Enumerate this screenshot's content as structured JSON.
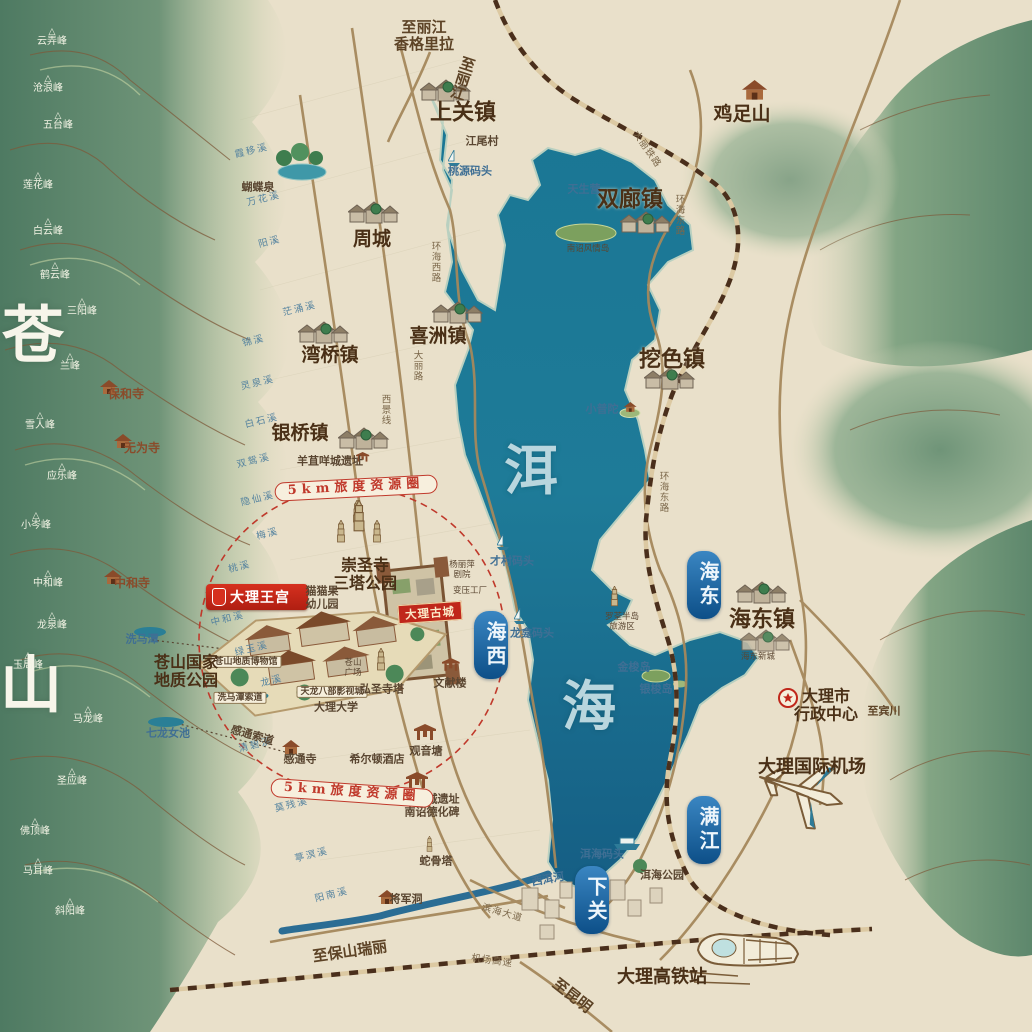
{
  "title": "大理洱海手绘旅游地图",
  "colors": {
    "paper": "#e9e0ca",
    "lake": "#1e7b98",
    "mountain_green": "#5f8a6e",
    "road": "#a5885c",
    "railway_dark": "#4a2f1c",
    "accent_red": "#c0392b",
    "stream_blue": "#55839f",
    "capsule_blue": "#0d4f88",
    "town_brown": "#4a3017"
  },
  "resort": {
    "logo": "大理王宫"
  },
  "old_town": {
    "label": "大理古城"
  },
  "labels": {
    "big_chars": [
      {
        "t": "苍",
        "x": 34,
        "y": 335,
        "cls": "mt"
      },
      {
        "t": "山",
        "x": 32,
        "y": 685,
        "cls": "mt"
      },
      {
        "t": "洱",
        "x": 532,
        "y": 470,
        "cls": "lake"
      },
      {
        "t": "海",
        "x": 590,
        "y": 706,
        "cls": "lake"
      }
    ],
    "regions": [
      {
        "t": "海西",
        "x": 491,
        "y": 645
      },
      {
        "t": "海东",
        "x": 704,
        "y": 585
      },
      {
        "t": "满江",
        "x": 704,
        "y": 830
      },
      {
        "t": "下关",
        "x": 592,
        "y": 900
      }
    ],
    "towns": [
      {
        "t": "上关镇",
        "x": 463,
        "y": 113,
        "cls": "lg"
      },
      {
        "t": "周城",
        "x": 372,
        "y": 240
      },
      {
        "t": "喜洲镇",
        "x": 438,
        "y": 337
      },
      {
        "t": "湾桥镇",
        "x": 330,
        "y": 356
      },
      {
        "t": "银桥镇",
        "x": 300,
        "y": 434
      },
      {
        "t": "双廊镇",
        "x": 630,
        "y": 200,
        "cls": "lg"
      },
      {
        "t": "挖色镇",
        "x": 672,
        "y": 360,
        "cls": "lg"
      },
      {
        "t": "海东镇",
        "x": 762,
        "y": 620,
        "cls": "lg"
      },
      {
        "t": "鸡足山",
        "x": 742,
        "y": 115
      }
    ],
    "peaks": [
      {
        "t": "云弄峰",
        "x": 52,
        "y": 38
      },
      {
        "t": "沧浪峰",
        "x": 48,
        "y": 85
      },
      {
        "t": "五台峰",
        "x": 58,
        "y": 122
      },
      {
        "t": "莲花峰",
        "x": 38,
        "y": 182
      },
      {
        "t": "白云峰",
        "x": 48,
        "y": 228
      },
      {
        "t": "鹤云峰",
        "x": 55,
        "y": 272
      },
      {
        "t": "三阳峰",
        "x": 82,
        "y": 308
      },
      {
        "t": "兰峰",
        "x": 70,
        "y": 363
      },
      {
        "t": "雪人峰",
        "x": 40,
        "y": 422
      },
      {
        "t": "应乐峰",
        "x": 62,
        "y": 473
      },
      {
        "t": "小岑峰",
        "x": 36,
        "y": 522
      },
      {
        "t": "中和峰",
        "x": 48,
        "y": 580
      },
      {
        "t": "龙泉峰",
        "x": 52,
        "y": 622
      },
      {
        "t": "玉局峰",
        "x": 28,
        "y": 662
      },
      {
        "t": "马龙峰",
        "x": 88,
        "y": 716
      },
      {
        "t": "圣应峰",
        "x": 72,
        "y": 778
      },
      {
        "t": "佛顶峰",
        "x": 35,
        "y": 828
      },
      {
        "t": "马耳峰",
        "x": 38,
        "y": 868
      },
      {
        "t": "斜阳峰",
        "x": 70,
        "y": 908
      }
    ],
    "temples": [
      {
        "t": "保和寺",
        "x": 126,
        "y": 395
      },
      {
        "t": "无为寺",
        "x": 142,
        "y": 449
      },
      {
        "t": "中和寺",
        "x": 132,
        "y": 584
      }
    ],
    "streams": [
      {
        "t": "霞移溪",
        "x": 252,
        "y": 152,
        "rot": -14
      },
      {
        "t": "万花溪",
        "x": 264,
        "y": 200,
        "rot": -14
      },
      {
        "t": "阳溪",
        "x": 270,
        "y": 243,
        "rot": -14
      },
      {
        "t": "茫涌溪",
        "x": 300,
        "y": 310,
        "rot": -14
      },
      {
        "t": "锦溪",
        "x": 254,
        "y": 342,
        "rot": -14
      },
      {
        "t": "灵泉溪",
        "x": 258,
        "y": 384,
        "rot": -14
      },
      {
        "t": "白石溪",
        "x": 262,
        "y": 422,
        "rot": -14
      },
      {
        "t": "双鸳溪",
        "x": 254,
        "y": 462,
        "rot": -14
      },
      {
        "t": "隐仙溪",
        "x": 258,
        "y": 500,
        "rot": -14
      },
      {
        "t": "梅溪",
        "x": 268,
        "y": 535,
        "rot": -14
      },
      {
        "t": "桃溪",
        "x": 240,
        "y": 568,
        "rot": -14
      },
      {
        "t": "中和溪",
        "x": 228,
        "y": 620,
        "rot": -14
      },
      {
        "t": "绿玉溪",
        "x": 252,
        "y": 650,
        "rot": -14
      },
      {
        "t": "龙溪",
        "x": 272,
        "y": 682,
        "rot": -14
      },
      {
        "t": "清碧溪",
        "x": 256,
        "y": 746,
        "rot": -14
      },
      {
        "t": "莫残溪",
        "x": 292,
        "y": 806,
        "rot": -14
      },
      {
        "t": "葶溟溪",
        "x": 312,
        "y": 856,
        "rot": -14
      },
      {
        "t": "阳南溪",
        "x": 332,
        "y": 896,
        "rot": -14
      }
    ],
    "pois": [
      {
        "t": "蝴蝶泉",
        "x": 258,
        "y": 188
      },
      {
        "t": "江尾村",
        "x": 482,
        "y": 142
      },
      {
        "t": "桃源码头",
        "x": 470,
        "y": 172,
        "cls": "blue"
      },
      {
        "t": "天生营",
        "x": 584,
        "y": 190,
        "cls": "blue"
      },
      {
        "t": "南诏风情岛",
        "x": 588,
        "y": 250,
        "cls": "tiny"
      },
      {
        "t": "小普陀",
        "x": 602,
        "y": 410,
        "cls": "blue"
      },
      {
        "t": "才村码头",
        "x": 512,
        "y": 562,
        "cls": "blue"
      },
      {
        "t": "龙龛码头",
        "x": 532,
        "y": 634,
        "cls": "blue"
      },
      {
        "t": "罗荃半岛\n旅游区",
        "x": 622,
        "y": 623,
        "cls": "tiny"
      },
      {
        "t": "金梭岛",
        "x": 634,
        "y": 668,
        "cls": "blue"
      },
      {
        "t": "银梭岛",
        "x": 656,
        "y": 690,
        "cls": "blue"
      },
      {
        "t": "洱海码头",
        "x": 602,
        "y": 855,
        "cls": "blue"
      },
      {
        "t": "洱海公园",
        "x": 662,
        "y": 876
      },
      {
        "t": "西洱河",
        "x": 548,
        "y": 880,
        "cls": "blue",
        "rot": -10
      },
      {
        "t": "羊苴咩城遗址",
        "x": 330,
        "y": 462
      },
      {
        "t": "崇圣寺\n三塔公园",
        "x": 365,
        "y": 575,
        "cls": "big"
      },
      {
        "t": "猫猫果\n幼儿园",
        "x": 322,
        "y": 598
      },
      {
        "t": "杨丽萍\n剧院",
        "x": 462,
        "y": 571,
        "cls": "tiny"
      },
      {
        "t": "变压工厂",
        "x": 470,
        "y": 592,
        "cls": "tiny"
      },
      {
        "t": "苍山地质博物馆",
        "x": 246,
        "y": 662,
        "cls": "box"
      },
      {
        "t": "洗马潭索道",
        "x": 240,
        "y": 698,
        "cls": "box"
      },
      {
        "t": "天龙八部影视城",
        "x": 332,
        "y": 692,
        "cls": "box"
      },
      {
        "t": "苍山\n广场",
        "x": 353,
        "y": 669,
        "cls": "tiny"
      },
      {
        "t": "大理大学",
        "x": 336,
        "y": 708
      },
      {
        "t": "弘圣寺塔",
        "x": 382,
        "y": 690
      },
      {
        "t": "文献楼",
        "x": 450,
        "y": 684
      },
      {
        "t": "观音塘",
        "x": 426,
        "y": 752
      },
      {
        "t": "感通寺",
        "x": 300,
        "y": 760
      },
      {
        "t": "希尔顿酒店",
        "x": 377,
        "y": 760
      },
      {
        "t": "感通索道",
        "x": 252,
        "y": 736,
        "rot": 16
      },
      {
        "t": "太和城遗址\n南诏德化碑",
        "x": 432,
        "y": 806
      },
      {
        "t": "蛇骨塔",
        "x": 436,
        "y": 862
      },
      {
        "t": "将军洞",
        "x": 406,
        "y": 900
      },
      {
        "t": "苍山国家\n地质公园",
        "x": 186,
        "y": 672,
        "cls": "big"
      },
      {
        "t": "洗马潭",
        "x": 142,
        "y": 640,
        "cls": "blue"
      },
      {
        "t": "七龙女池",
        "x": 168,
        "y": 734,
        "cls": "blue"
      },
      {
        "t": "海东新城",
        "x": 758,
        "y": 658,
        "cls": "tiny"
      },
      {
        "t": "大理市\n行政中心",
        "x": 826,
        "y": 706,
        "cls": "big"
      },
      {
        "t": "大理国际机场",
        "x": 812,
        "y": 768,
        "cls": "xl"
      },
      {
        "t": "大理高铁站",
        "x": 662,
        "y": 978,
        "cls": "xl"
      }
    ],
    "roads": [
      {
        "t": "环海西路",
        "x": 434,
        "y": 262,
        "cls": "vert"
      },
      {
        "t": "大丽路",
        "x": 416,
        "y": 366,
        "cls": "vert"
      },
      {
        "t": "西景线",
        "x": 384,
        "y": 410,
        "cls": "vert"
      },
      {
        "t": "环海东路",
        "x": 678,
        "y": 215,
        "cls": "vert"
      },
      {
        "t": "大丽铁路",
        "x": 646,
        "y": 150,
        "rot": 55
      },
      {
        "t": "环海东路",
        "x": 662,
        "y": 492,
        "cls": "vert"
      },
      {
        "t": "滨海大道",
        "x": 502,
        "y": 914,
        "rot": 16
      },
      {
        "t": "机场高速",
        "x": 492,
        "y": 962,
        "rot": 8
      }
    ],
    "directions": [
      {
        "t": "至丽江\n香格里拉",
        "x": 424,
        "y": 36
      },
      {
        "t": "至丽江",
        "x": 462,
        "y": 78,
        "cls": "vert",
        "rot": 18
      },
      {
        "t": "至宾川",
        "x": 884,
        "y": 712,
        "cls": "sm"
      },
      {
        "t": "至昆明",
        "x": 572,
        "y": 996,
        "rot": 38
      },
      {
        "t": "至保山瑞丽",
        "x": 350,
        "y": 952,
        "rot": -8
      }
    ],
    "pills": [
      {
        "t": "5km旅度资源圈",
        "x": 356,
        "y": 488,
        "rot": -3
      },
      {
        "t": "5km旅度资源圈",
        "x": 352,
        "y": 793,
        "rot": 4
      }
    ]
  }
}
